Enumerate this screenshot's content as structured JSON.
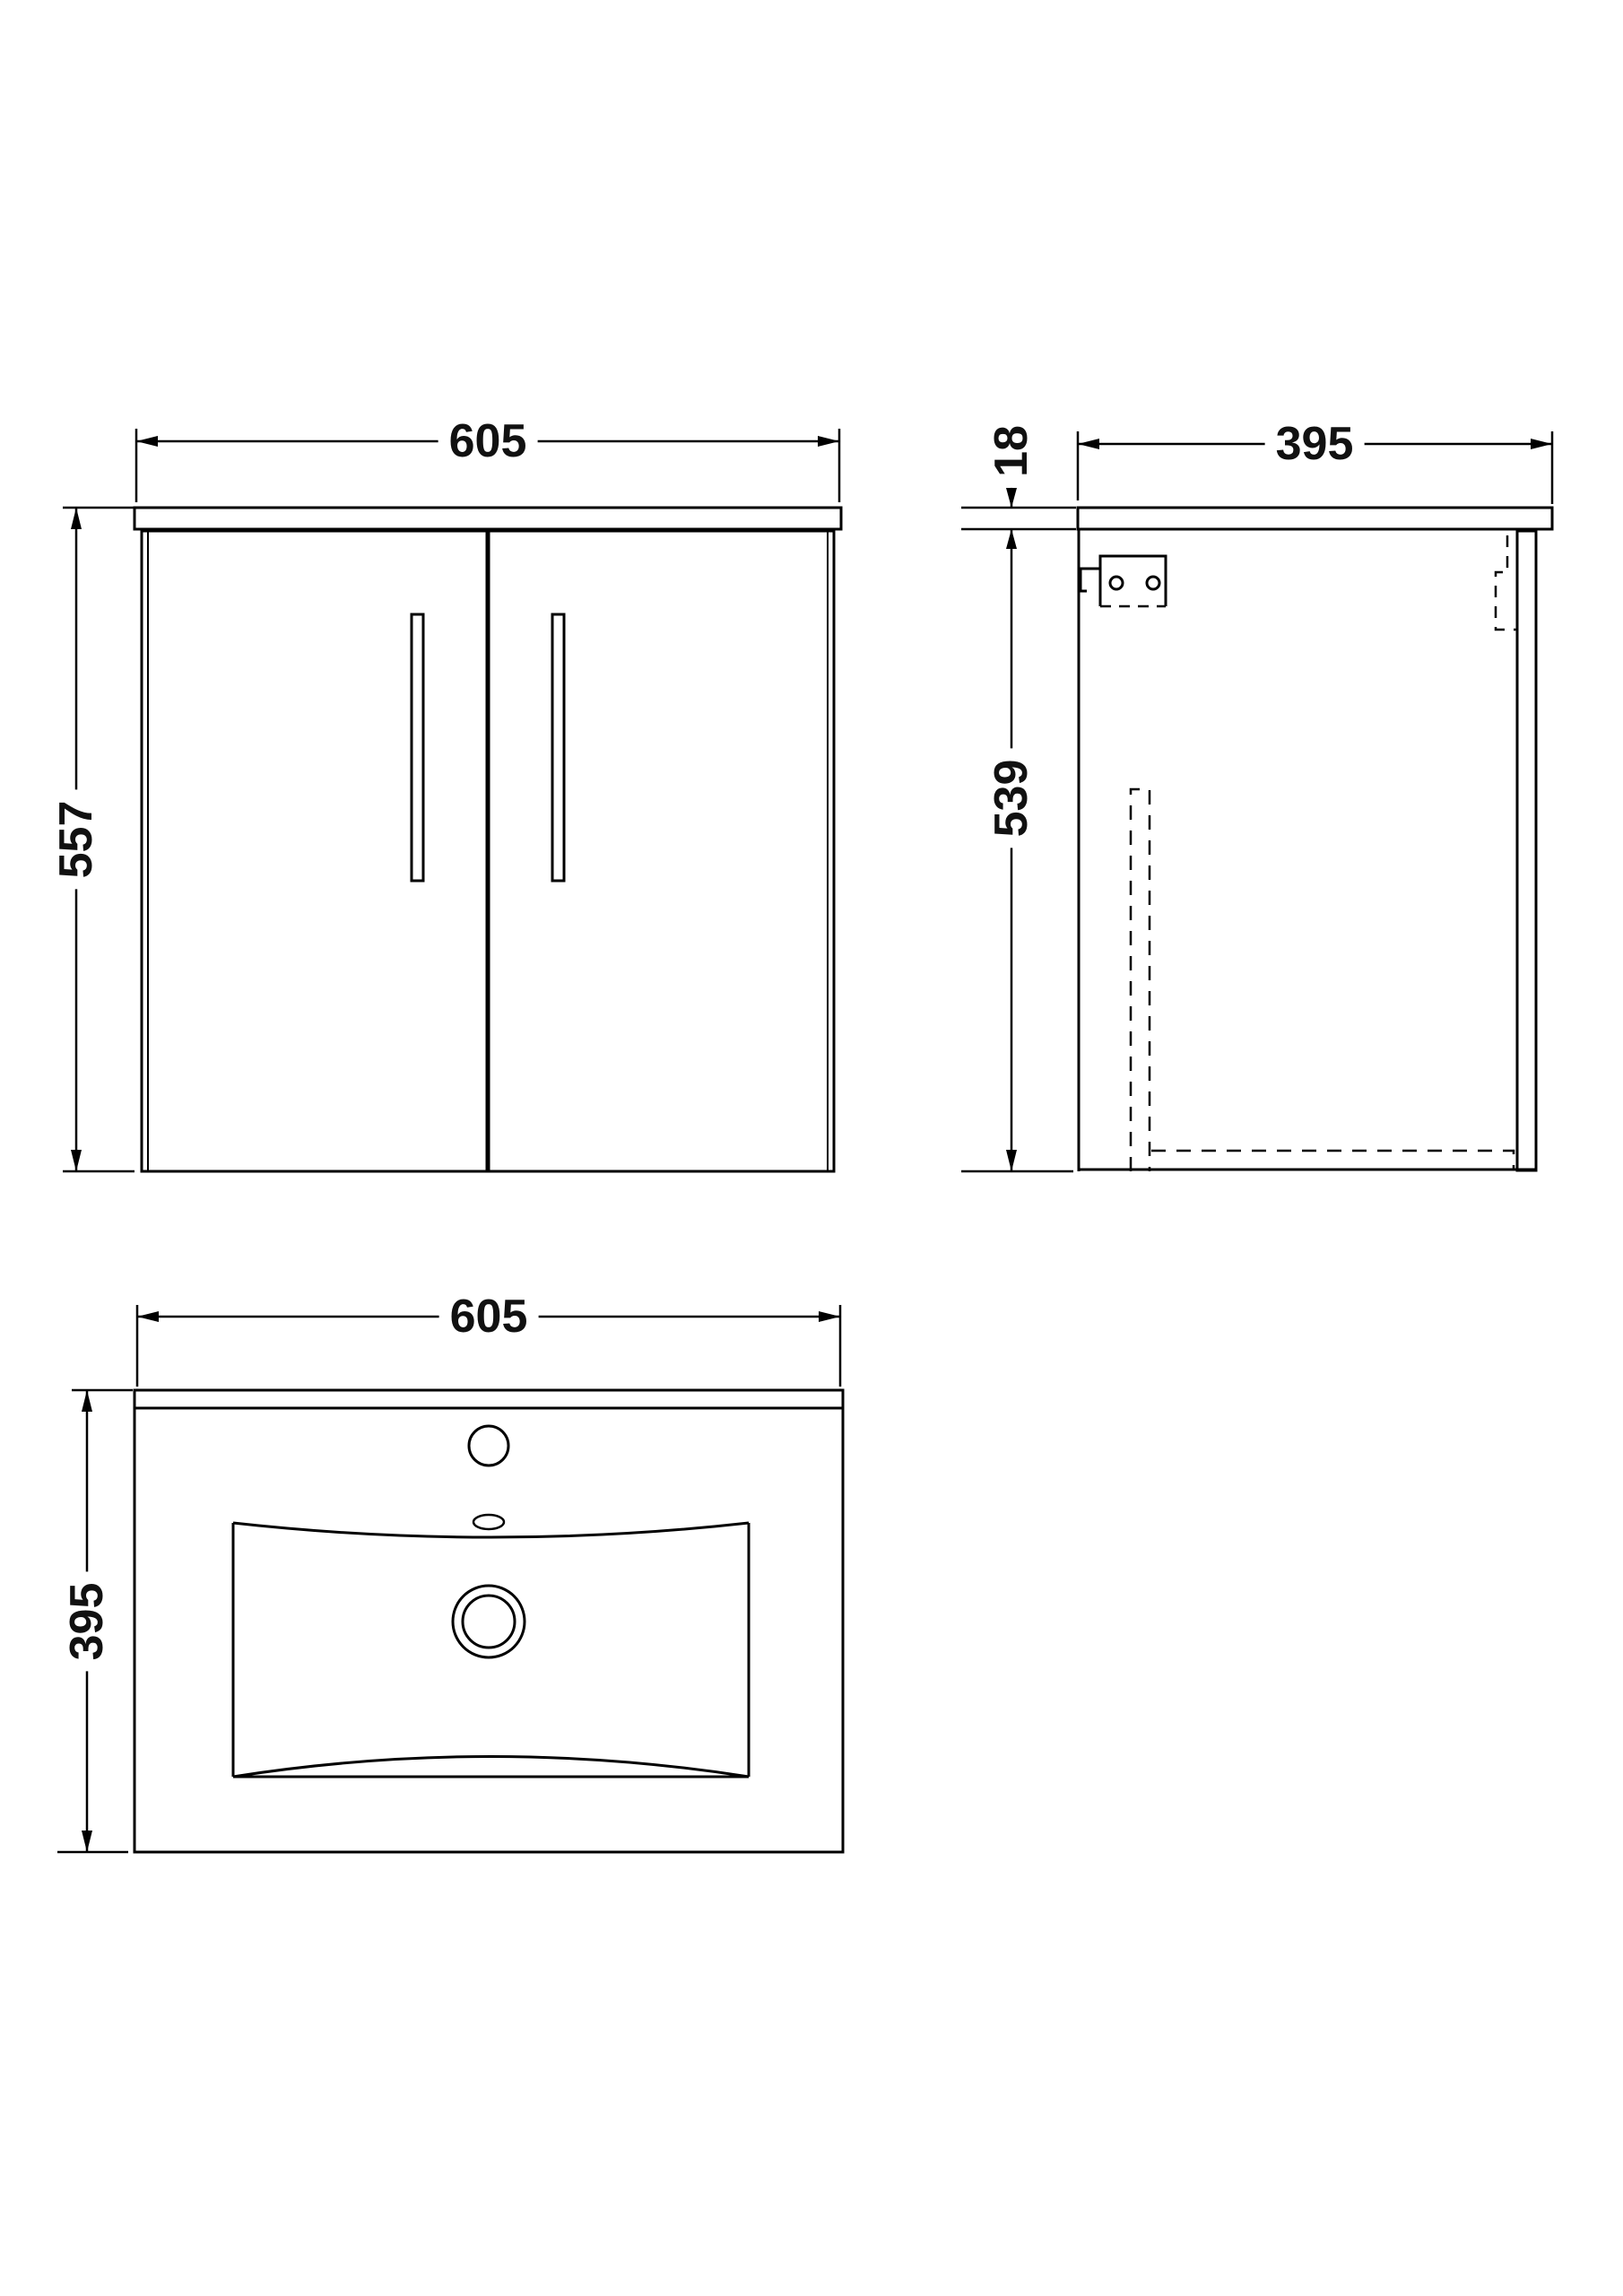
{
  "drawing": {
    "type": "technical-dimension-diagram",
    "subject": "wall-hung vanity unit with basin",
    "background_color": "#ffffff",
    "line_color": "#000000",
    "text_color": "#111111",
    "views": {
      "front": {
        "width_dim": "605",
        "height_dim": "557"
      },
      "side": {
        "depth_dim": "395",
        "worktop_thickness_dim": "18",
        "carcass_height_dim": "539"
      },
      "plan": {
        "width_dim": "605",
        "depth_dim": "395"
      }
    }
  }
}
